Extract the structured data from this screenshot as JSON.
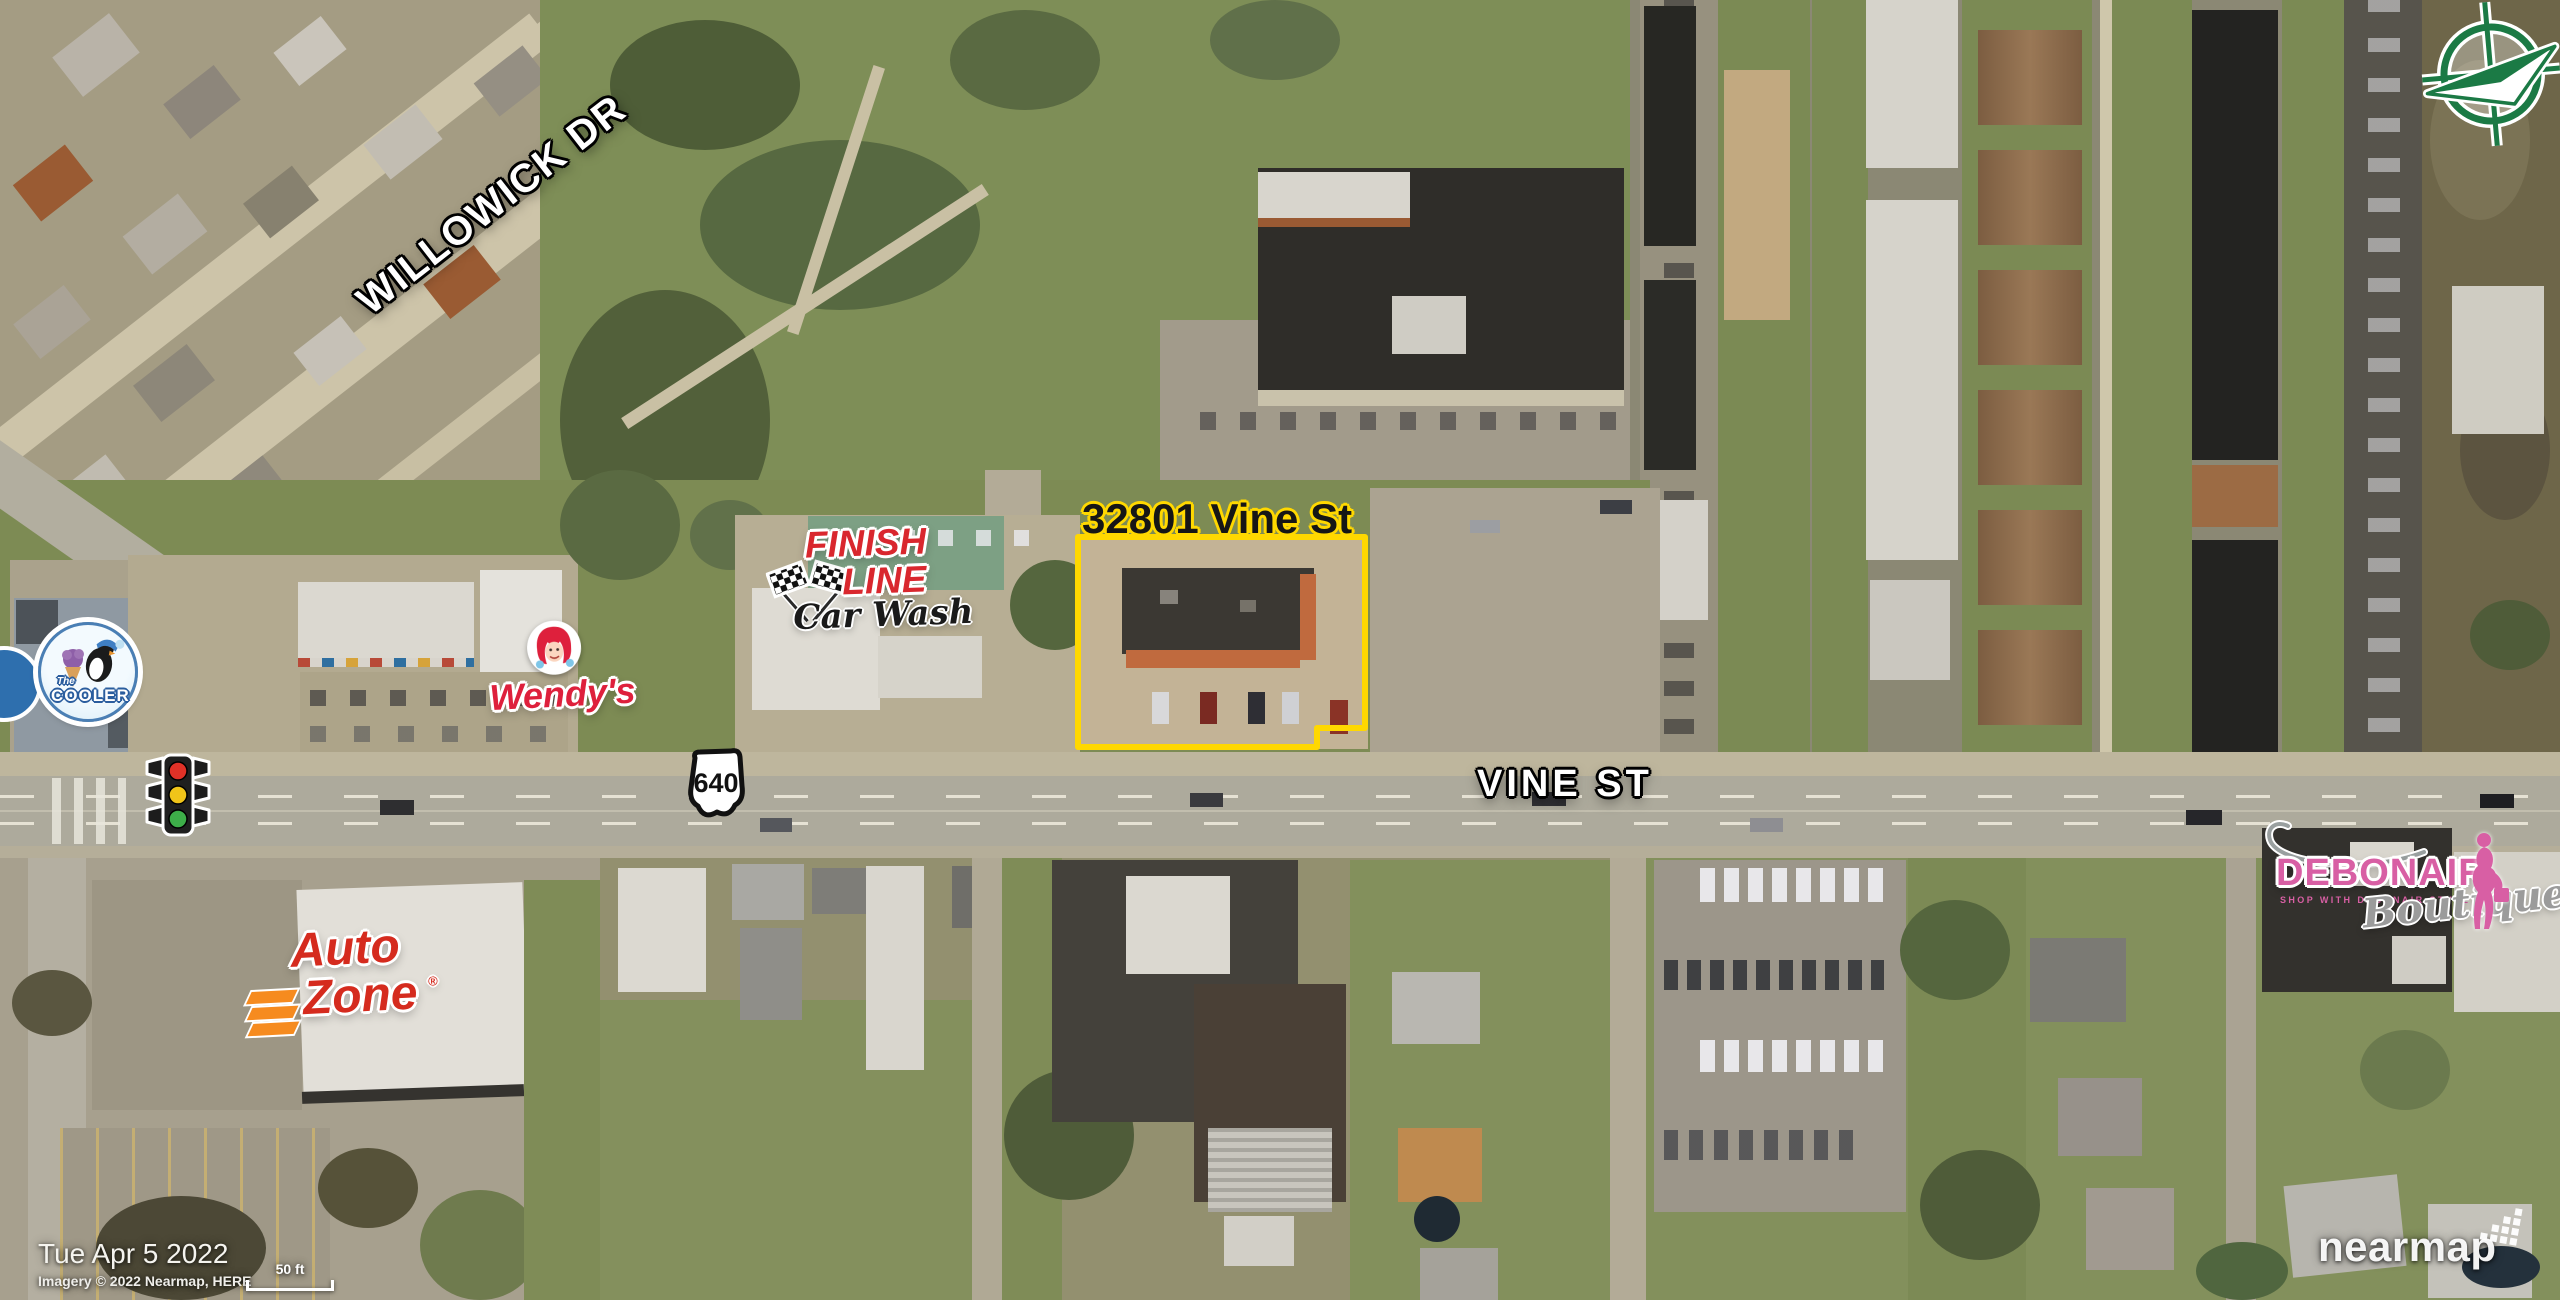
{
  "annotations": {
    "subject_parcel": {
      "label": "32801 Vine St"
    },
    "street_labels": {
      "willowick": "WILLOWICK DR",
      "vine": "VINE ST"
    },
    "route_shield": {
      "number": "640"
    },
    "logos": {
      "cooler": {
        "line1": "The",
        "line2": "COOLER"
      },
      "wendys": {
        "name": "Wendy's"
      },
      "finish_line": {
        "line1": "FINISH",
        "line2": "LINE",
        "line3": "Car Wash"
      },
      "autozone": {
        "line1": "Auto",
        "line2": "Zone",
        "registered": "®"
      },
      "debonair": {
        "name": "DEBONAIR",
        "tagline": "SHOP WITH DEBONAIR STYLE",
        "script": "Boutique"
      }
    }
  },
  "footer": {
    "date": "Tue Apr 5 2022",
    "attribution": "Imagery © 2022 Nearmap, HERE",
    "scale_label": "50 ft"
  },
  "watermark": {
    "brand": "nearmap"
  },
  "colors": {
    "parcel_yellow": "#ffd800",
    "label_white": "#ffffff",
    "compass_green": "#1b7a45",
    "finish_red": "#d9272e",
    "wendys_red": "#de203c",
    "autozone_red": "#d52b1e",
    "autozone_orange": "#f68b1f",
    "debonair_pink": "#d85fa4",
    "debonair_gray": "#9b9b9b",
    "cooler_blue": "#4a7fb5",
    "cooler_purple": "#8e5fa8",
    "traffic_red": "#e03127",
    "traffic_amber": "#f0c419",
    "traffic_green": "#3dae49"
  }
}
